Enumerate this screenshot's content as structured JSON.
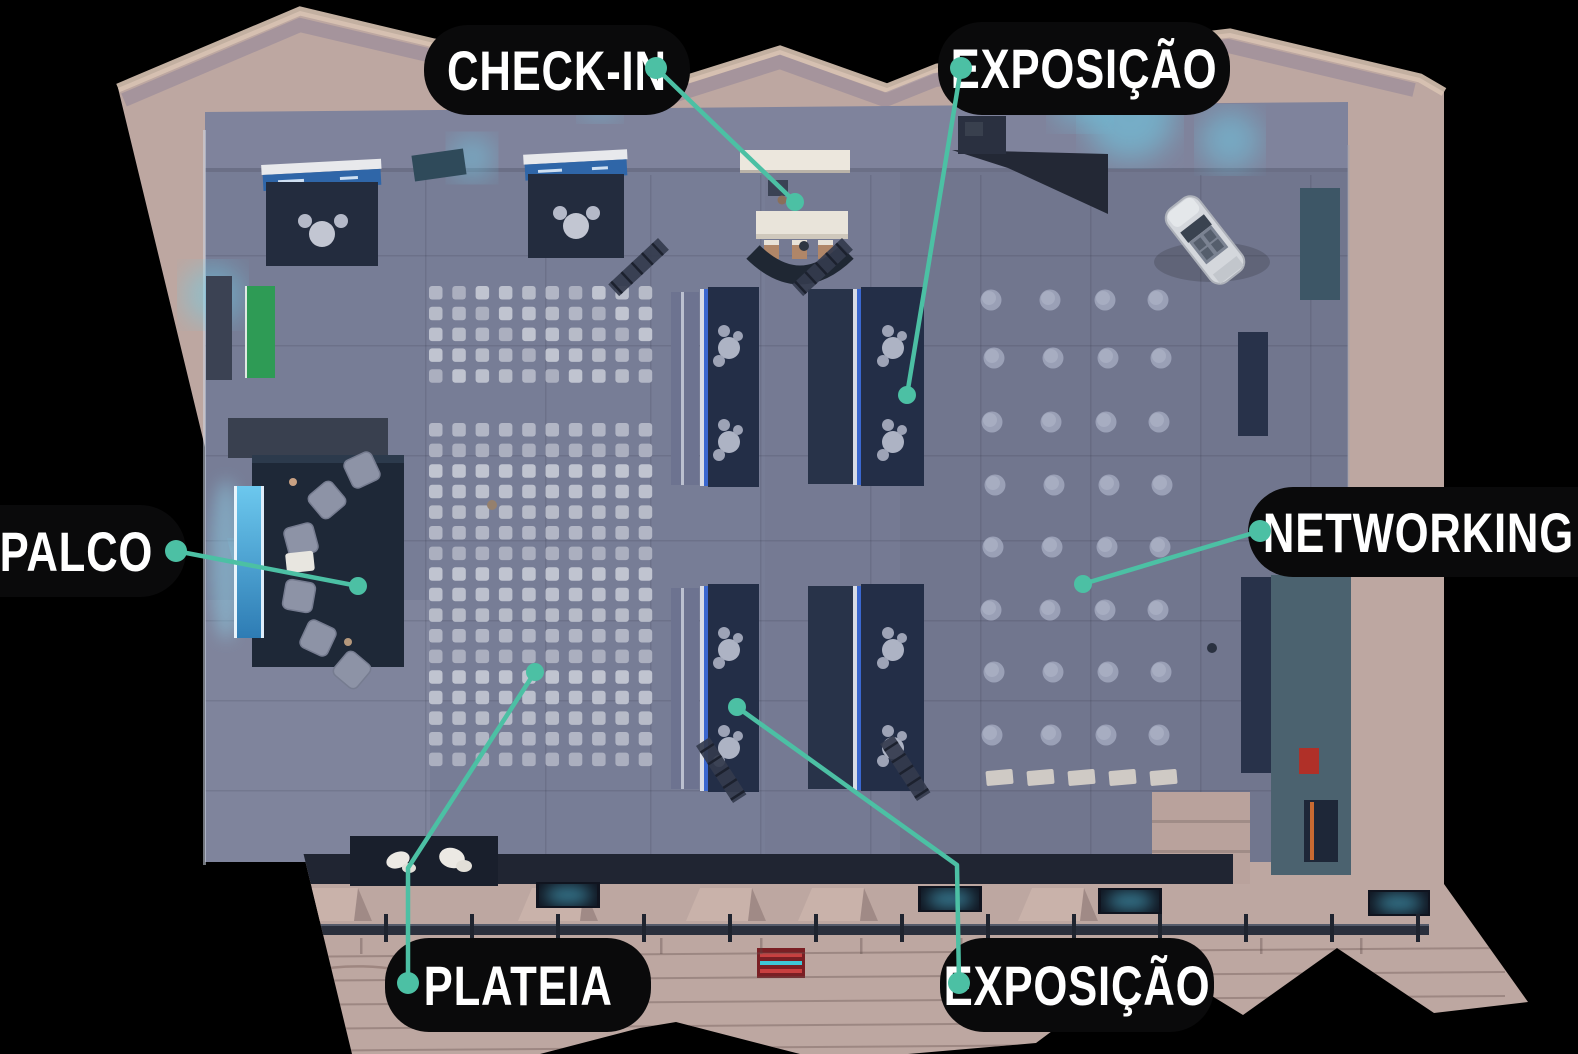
{
  "colors": {
    "accent": "#4cc0a4",
    "label_bg": "#0a0a0b",
    "label_text": "#ffffff",
    "wall": "#bda7a1",
    "floor": "#757a93",
    "booth_dark": "#232e47",
    "screen_blue": "#4aa8d8",
    "glow_cyan": "#6ed0ea"
  },
  "labels": [
    {
      "id": "check-in",
      "text": "CHECK-IN",
      "box": [
        424,
        25,
        266,
        90
      ],
      "corners": "all",
      "line": [
        [
          656,
          68
        ],
        [
          795,
          202
        ]
      ]
    },
    {
      "id": "exposicao-top",
      "text": "EXPOSIÇÃO",
      "box": [
        938,
        22,
        292,
        93
      ],
      "corners": "all",
      "line": [
        [
          961,
          68
        ],
        [
          907,
          395
        ]
      ]
    },
    {
      "id": "palco",
      "text": "PALCO",
      "box": [
        -34,
        505,
        220,
        92
      ],
      "corners": "right",
      "line": [
        [
          176,
          551
        ],
        [
          358,
          586
        ]
      ]
    },
    {
      "id": "networking",
      "text": "NETWORKING",
      "box": [
        1248,
        487,
        340,
        90
      ],
      "corners": "left",
      "line": [
        [
          1260,
          531
        ],
        [
          1083,
          584
        ]
      ]
    },
    {
      "id": "plateia",
      "text": "PLATEIA",
      "box": [
        385,
        938,
        266,
        94
      ],
      "corners": "all",
      "line": [
        [
          408,
          983
        ],
        [
          408,
          868
        ],
        [
          535,
          672
        ]
      ]
    },
    {
      "id": "exposicao-bottom",
      "text": "EXPOSIÇÃO",
      "box": [
        940,
        938,
        274,
        94
      ],
      "corners": "all",
      "line": [
        [
          959,
          983
        ],
        [
          957,
          865
        ],
        [
          737,
          707
        ]
      ]
    }
  ]
}
